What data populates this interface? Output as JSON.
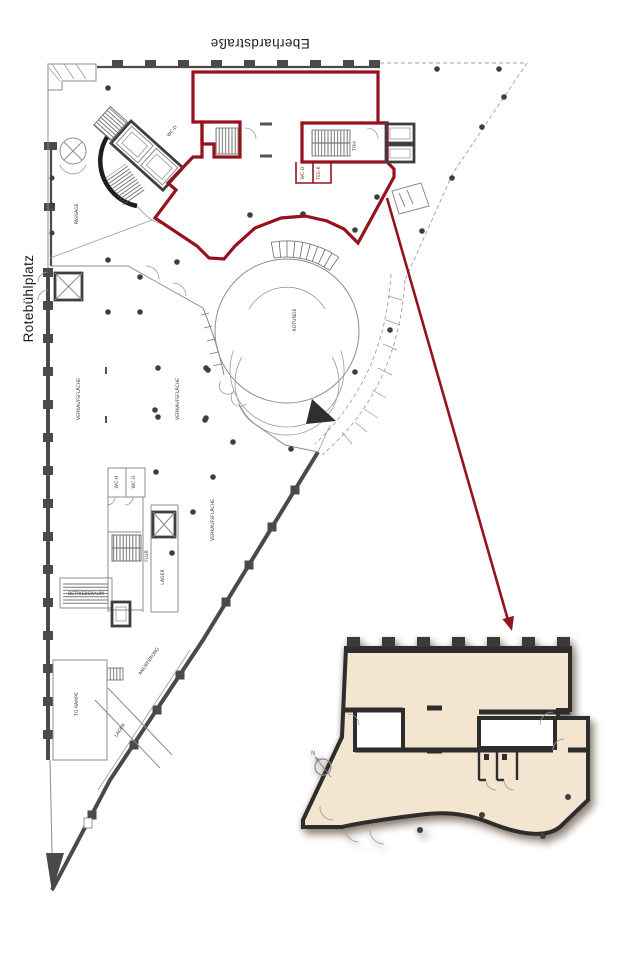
{
  "colors": {
    "highlight": "#96121d",
    "wall": "#4a4a4a",
    "dark": "#2d2d2d",
    "beige": "#f4e5d0",
    "dot": "#3e3e3e"
  },
  "labels": {
    "street_top": "Eberhardstraße",
    "street_left": "Rotebühlplatz"
  },
  "plan_labels": {
    "passage": "PASSAGE",
    "verkaufsflaeche_1": "VERKAUFSFLÄCHE",
    "verkaufsflaeche_2": "VERKAUFSFLÄCHE",
    "verkaufsflaeche_3": "VERKAUFSFLÄCHE",
    "rotunde": "ROTUNDE",
    "flur": "FLUR",
    "lager_1": "LAGER",
    "betriebsraum": "BETRIEBSRAUM",
    "tg_rampe": "TG RAMPE",
    "lager_2": "LAGER",
    "anlieferung": "ANLIEFERUNG",
    "trh": "TRH",
    "wc_d": "WC-D",
    "tee_k": "TEE-K",
    "wc_h_2": "WC-H",
    "wc_d_2": "WC-D",
    "wc_d_3": "WC-D",
    "north": "N"
  }
}
